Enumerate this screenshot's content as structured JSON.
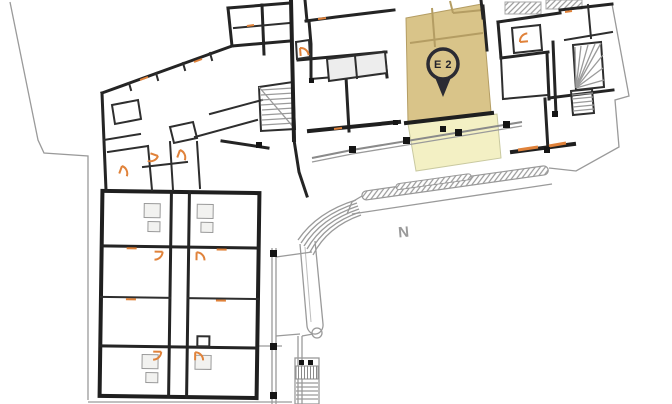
{
  "plan": {
    "marker": {
      "label": "E 2"
    },
    "compass": {
      "label": "N"
    },
    "colors": {
      "unit_highlight": "#d9c489",
      "terrace_highlight": "#f3f0c4",
      "pin_outline": "#2b2b33",
      "pin_text": "#23232b",
      "wall_black": "#1f1f1f",
      "outline_gray": "#9a9a9a",
      "door_orange": "#e0823a",
      "background": "#ffffff"
    }
  }
}
